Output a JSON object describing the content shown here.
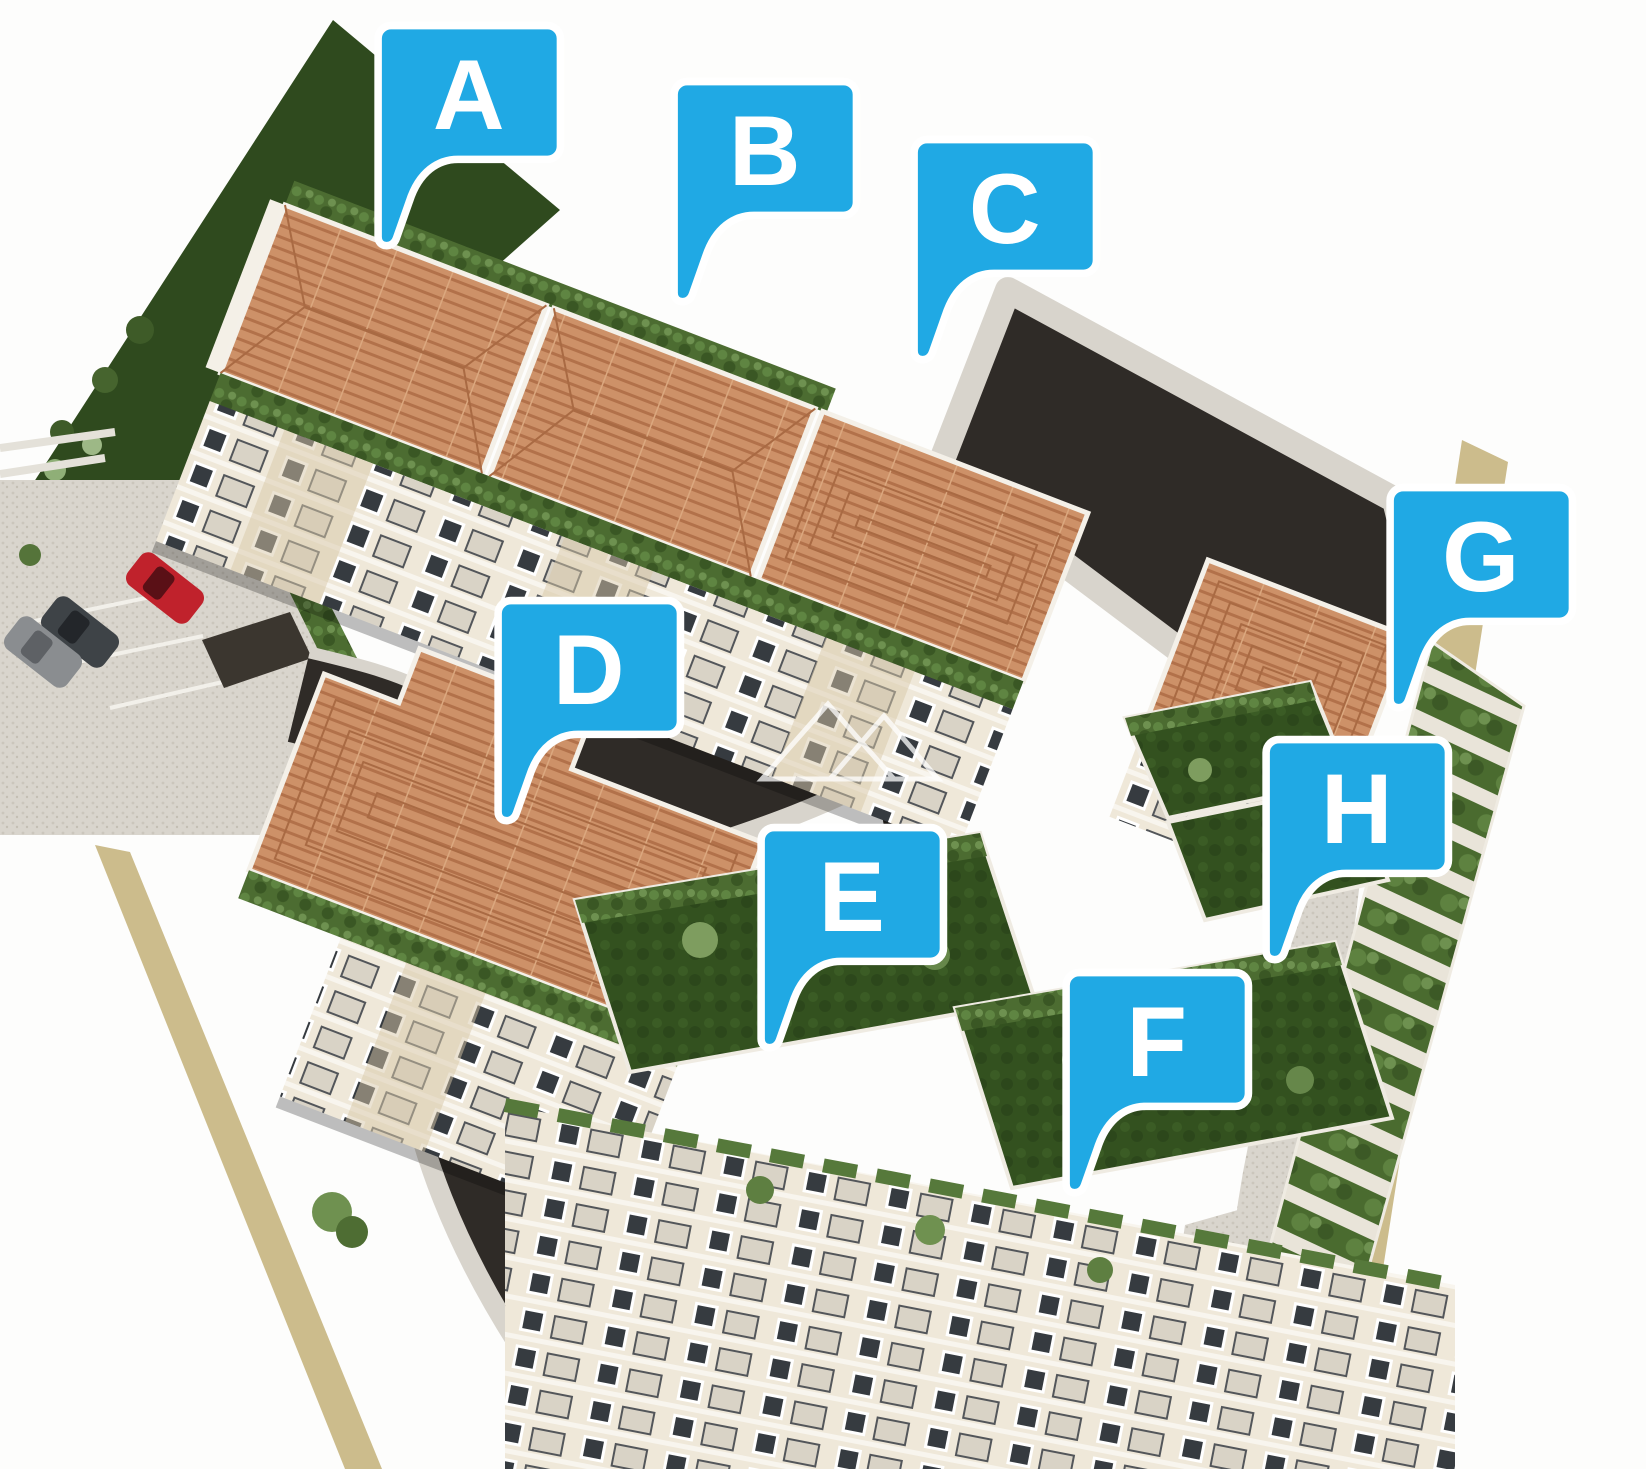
{
  "scene": {
    "kind": "aerial-3d-residential-site-render",
    "watermark_icon": "twin-triangles-watermark",
    "colors": {
      "label_blue": "#20A9E4",
      "label_border": "#FFFFFF",
      "label_text": "#FFFFFF",
      "roof_terracotta": "#CD9168",
      "roof_tile_line": "#B2714A",
      "lawn_green": "#33511F",
      "shrub_green": "#4C6C31",
      "asphalt": "#2F2B27",
      "pavement": "#D8D4CC",
      "facade_cream": "#EFE8D9",
      "facade_beige": "#D8C7A8",
      "boundary_tan": "#CCBC8C",
      "car_red": "#C0222C",
      "car_grey": "#8A8D90",
      "car_dark": "#3E4347"
    },
    "vehicles": [
      "red-car",
      "dark-grey-car",
      "grey-car",
      "parked-car",
      "parked-car"
    ]
  },
  "labels": [
    {
      "letter": "A"
    },
    {
      "letter": "B"
    },
    {
      "letter": "C"
    },
    {
      "letter": "D"
    },
    {
      "letter": "E"
    },
    {
      "letter": "F"
    },
    {
      "letter": "G"
    },
    {
      "letter": "H"
    }
  ]
}
